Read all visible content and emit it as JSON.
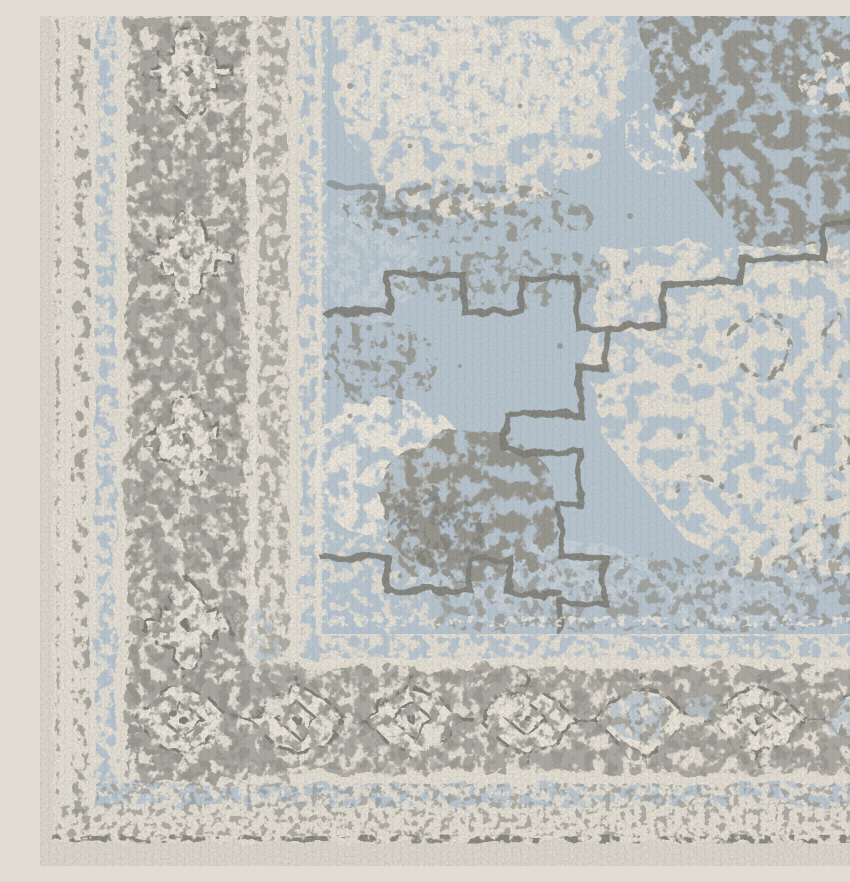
{
  "image": {
    "kind": "photograph",
    "alt": "Close-up corner detail of a distressed vintage-style area rug: light blue medallion field with eroded grey and cream pattern, ornate grey border bands with diamond rosette motifs, blue guard stripes, and a plain cream outer binding."
  },
  "palette": {
    "floor": "#e2ddd3",
    "cream": "#ece6da",
    "cream_light": "#f3eee3",
    "blue": "#b7c8d6",
    "blue_light": "#cfdae2",
    "gray": "#8f8e86",
    "gray_dark": "#72716a",
    "gray_band": "#a4a39b"
  },
  "regions": {
    "field": "distressed light-blue field with stepped medallion outline",
    "border_main": "grey main border with rosette motifs",
    "guards": "blue and cream guard stripes",
    "binding": "cream outer binding strip and backdrop"
  }
}
